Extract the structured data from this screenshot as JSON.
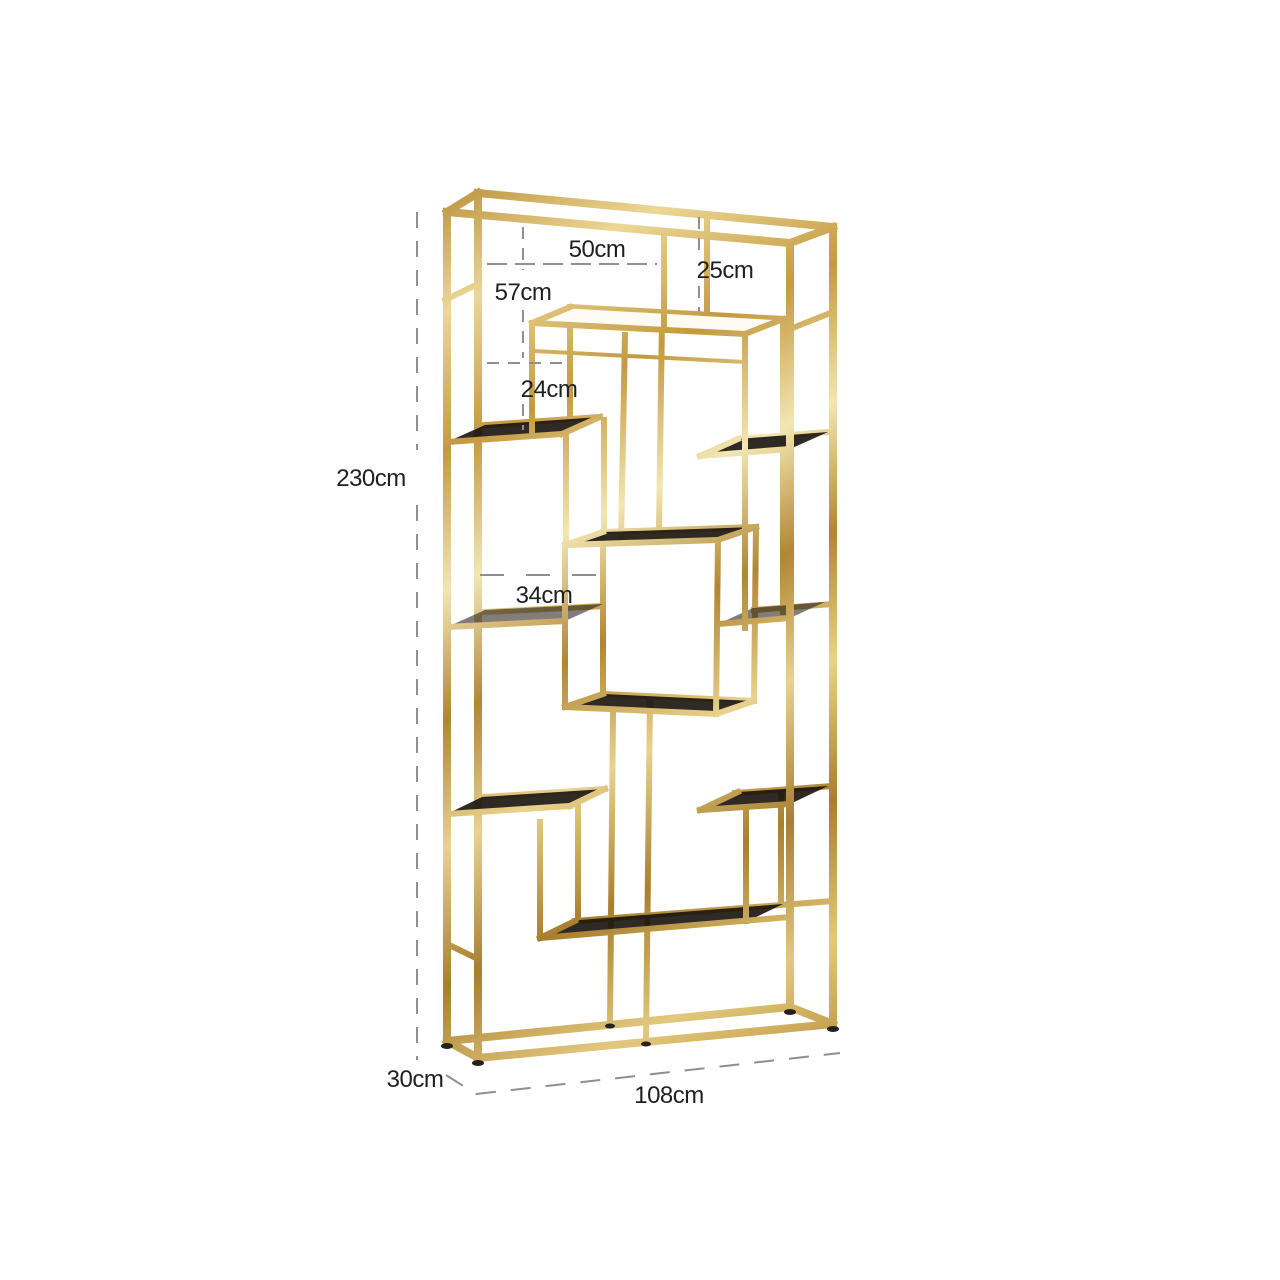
{
  "diagram": {
    "dimensions": {
      "overall_height": "230cm",
      "overall_width": "108cm",
      "overall_depth": "30cm",
      "top_shelf_width": "50cm",
      "top_right_section_height": "25cm",
      "upper_left_section_height": "57cm",
      "upper_left_shelf_height": "24cm",
      "middle_shelf_width": "34cm"
    },
    "colors": {
      "background": "#ffffff",
      "frame_gold": "#c8a251",
      "frame_gold_light": "#f3e6b1",
      "frame_gold_dark": "#a87f2e",
      "glass_dark": "#18130c",
      "glass_light": "#fdfbf4",
      "dimension_line": "#8f8f8f",
      "dimension_text": "#1f1f1f"
    }
  }
}
